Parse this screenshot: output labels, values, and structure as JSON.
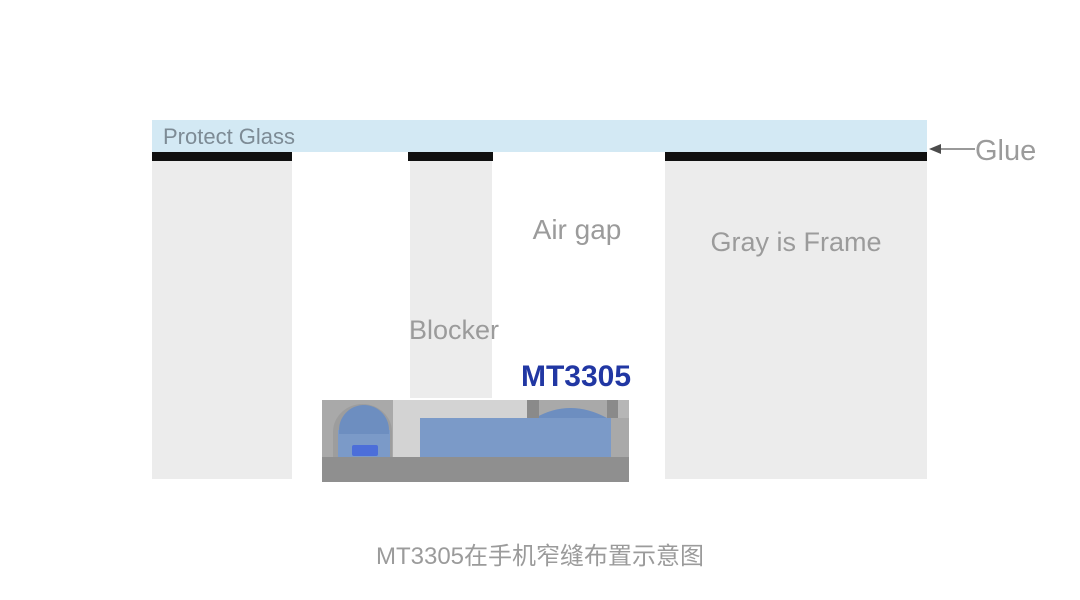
{
  "diagram": {
    "labels": {
      "protect_glass": "Protect Glass",
      "glue": "Glue",
      "air_gap": "Air gap",
      "gray_is_frame": "Gray is Frame",
      "blocker": "Blocker",
      "sensor_model": "MT3305"
    },
    "caption": "MT3305在手机窄缝布置示意图",
    "colors": {
      "glass": "#d3e9f4",
      "glue_black": "#101010",
      "frame_gray": "#ececec",
      "label_gray": "#9b9b9b",
      "glass_label": "#7d8b95",
      "model_blue": "#2137a3",
      "arrow_line": "#999999",
      "arrow_head": "#4c4c4c",
      "module_housing": "#a9a9a9",
      "module_recess": "#9d9d9d",
      "module_base": "#8f8f8f",
      "module_body_blue": "#7b9ac8",
      "module_dome_blue": "#6d8ec0",
      "module_led_blue": "#4c6ed9",
      "module_gap_light": "#d3d3d3",
      "module_post_dark": "#8a8a8a",
      "module_corner_light": "#b6b6b6"
    }
  }
}
